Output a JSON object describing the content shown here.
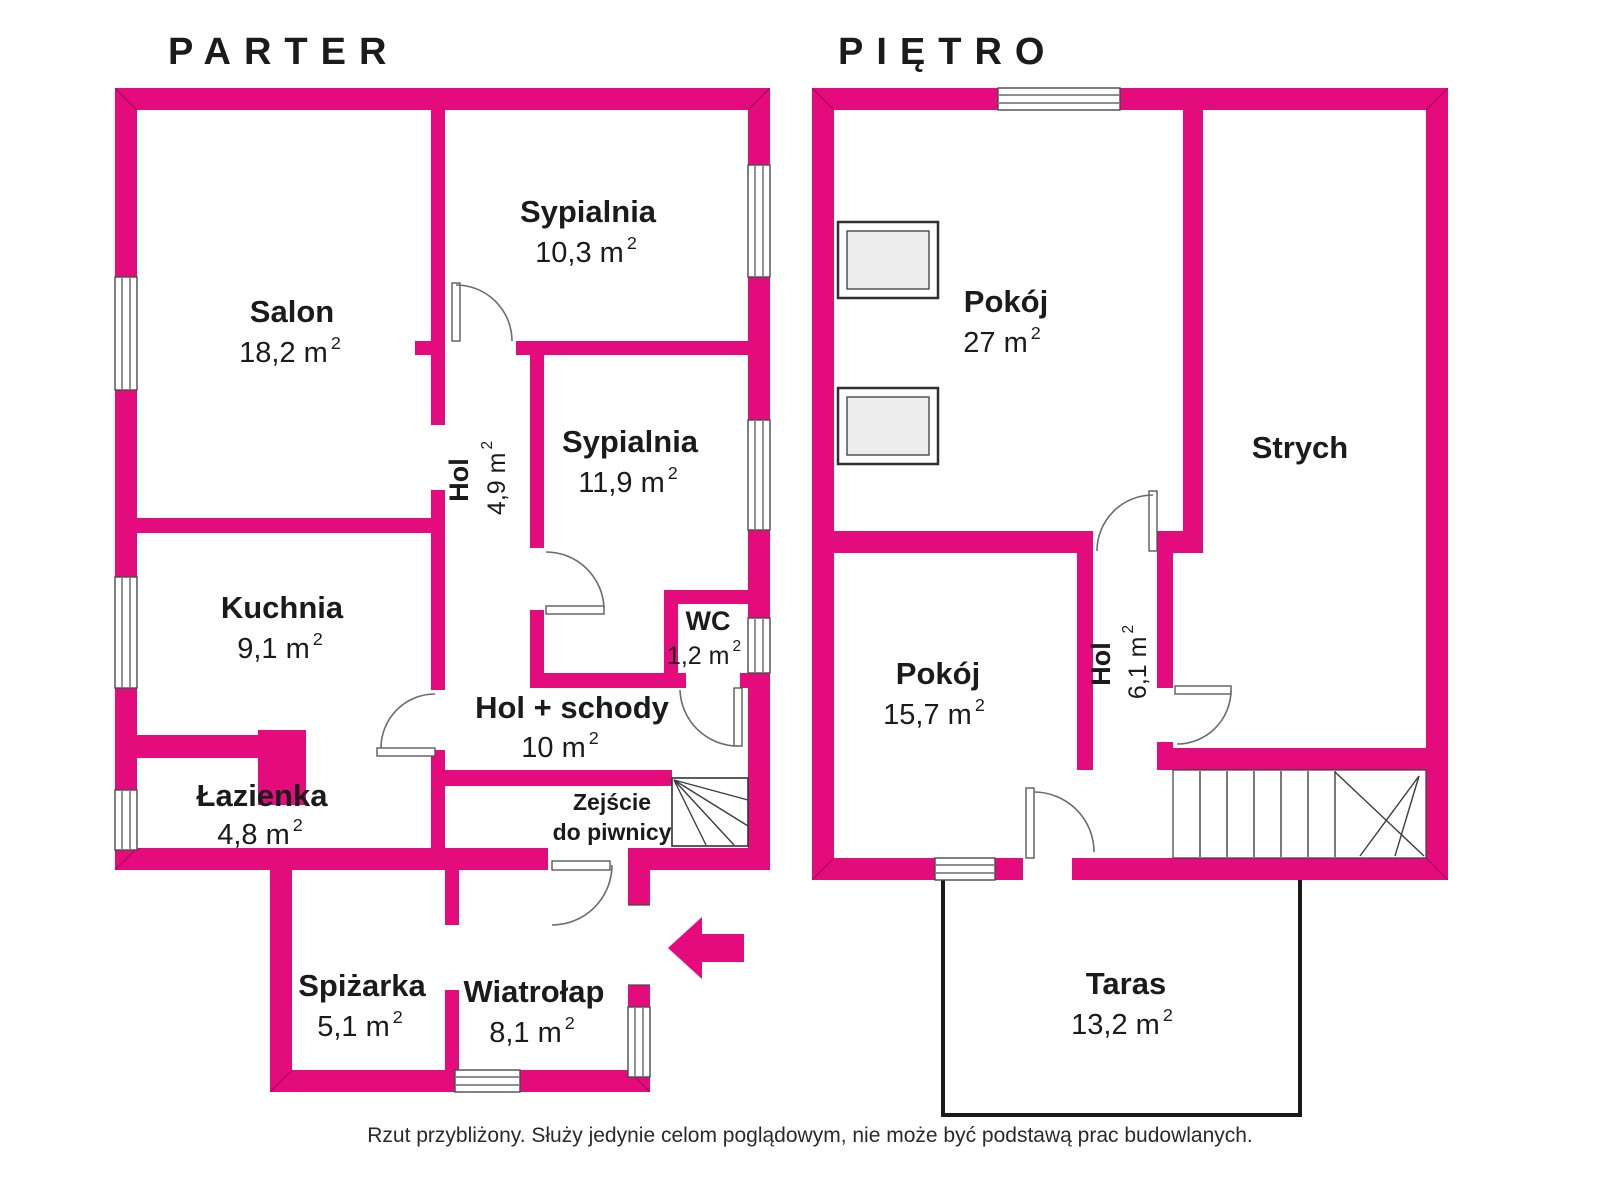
{
  "floors": [
    {
      "title": "PARTER",
      "rooms": [
        {
          "id": "salon",
          "name": "Salon",
          "area": "18,2 m²"
        },
        {
          "id": "sypialnia-1",
          "name": "Sypialnia",
          "area": "10,3 m²"
        },
        {
          "id": "hol",
          "name": "Hol",
          "area": "4,9 m²"
        },
        {
          "id": "sypialnia-2",
          "name": "Sypialnia",
          "area": "11,9 m²"
        },
        {
          "id": "kuchnia",
          "name": "Kuchnia",
          "area": "9,1 m²"
        },
        {
          "id": "wc",
          "name": "WC",
          "area": "1,2 m²"
        },
        {
          "id": "hol-schody",
          "name": "Hol + schody",
          "area": "10 m²"
        },
        {
          "id": "lazienka",
          "name": "Łazienka",
          "area": "4,8 m²"
        },
        {
          "id": "spizarka",
          "name": "Spiżarka",
          "area": "5,1 m²"
        },
        {
          "id": "wiatrolap",
          "name": "Wiatrołap",
          "area": "8,1 m²"
        },
        {
          "id": "zejscie",
          "name": "Zejście do piwnicy",
          "line1": "Zejście",
          "line2": "do piwnicy"
        }
      ]
    },
    {
      "title": "PIĘTRO",
      "rooms": [
        {
          "id": "pokoj-1",
          "name": "Pokój",
          "area": "27 m²"
        },
        {
          "id": "strych",
          "name": "Strych"
        },
        {
          "id": "pokoj-2",
          "name": "Pokój",
          "area": "15,7 m²"
        },
        {
          "id": "hol-pietro",
          "name": "Hol",
          "area": "6,1 m²"
        },
        {
          "id": "taras",
          "name": "Taras",
          "area": "13,2 m²"
        }
      ]
    }
  ],
  "footer": "Rzut przybliżony. Służy jedynie celom poglądowym, nie może być podstawą prac budowlanych.",
  "colors": {
    "wall": "#e40b7d",
    "text": "#1b1b1b",
    "window_line": "#4a4a4a"
  }
}
